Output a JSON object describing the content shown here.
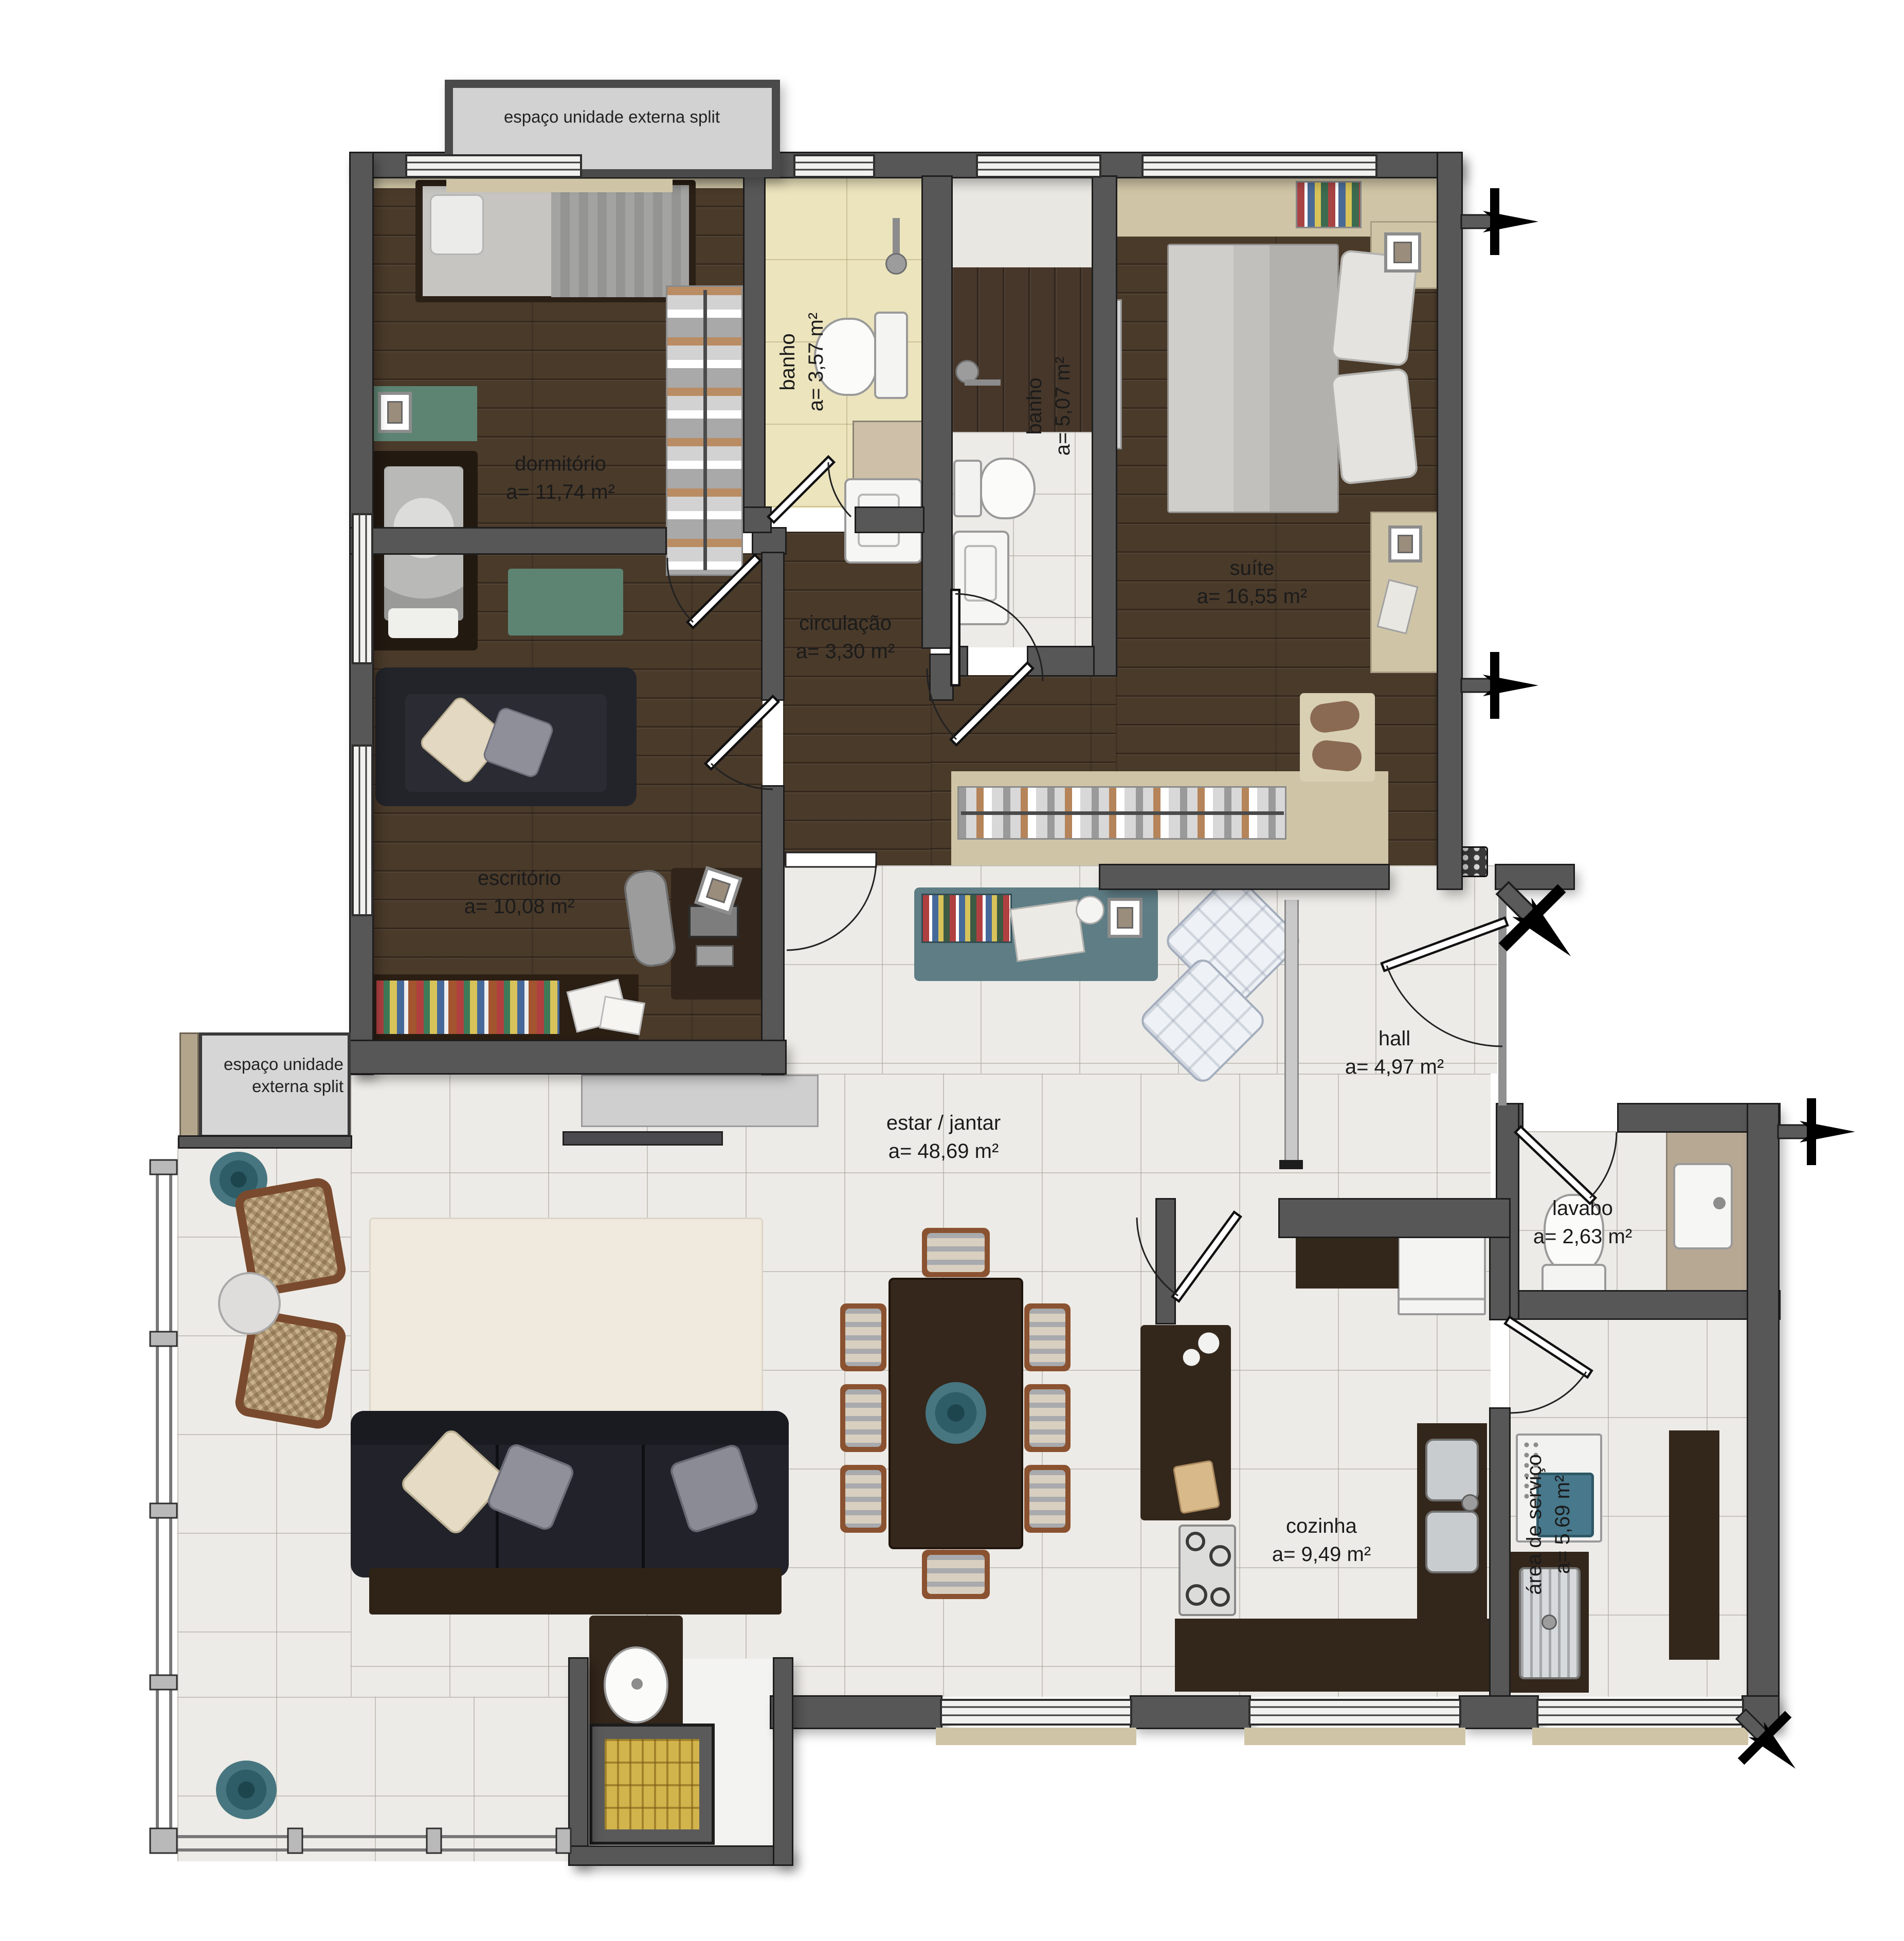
{
  "plan": {
    "external_labels": {
      "top": "espaço unidade externa split",
      "left1": "espaço unidade",
      "left2": "externa split"
    },
    "rooms": [
      {
        "name": "dormitório",
        "area": "a= 11,74 m²"
      },
      {
        "name": "banho",
        "area": "a= 3,57 m²"
      },
      {
        "name": "banho",
        "area": "a= 5,07 m²"
      },
      {
        "name": "suíte",
        "area": "a= 16,55 m²"
      },
      {
        "name": "circulação",
        "area": "a= 3,30 m²"
      },
      {
        "name": "escritório",
        "area": "a= 10,08 m²"
      },
      {
        "name": "estar / jantar",
        "area": "a= 48,69 m²"
      },
      {
        "name": "hall",
        "area": "a= 4,97 m²"
      },
      {
        "name": "lavabo",
        "area": "a= 2,63 m²"
      },
      {
        "name": "cozinha",
        "area": "a= 9,49 m²"
      },
      {
        "name": "área de serviço",
        "area": "a= 5,69 m²"
      }
    ],
    "colors": {
      "wall": "#575757",
      "wood_floor": "#4a3a2a",
      "cream_tile": "#ece4bd",
      "white_tile": "#edebe7",
      "beige_band": "#cfc5a6",
      "accent_green": "#5d8473",
      "accent_teal": "#5e7d85",
      "washer_teal": "#47788c",
      "grill_yellow": "#d2b44c"
    }
  }
}
